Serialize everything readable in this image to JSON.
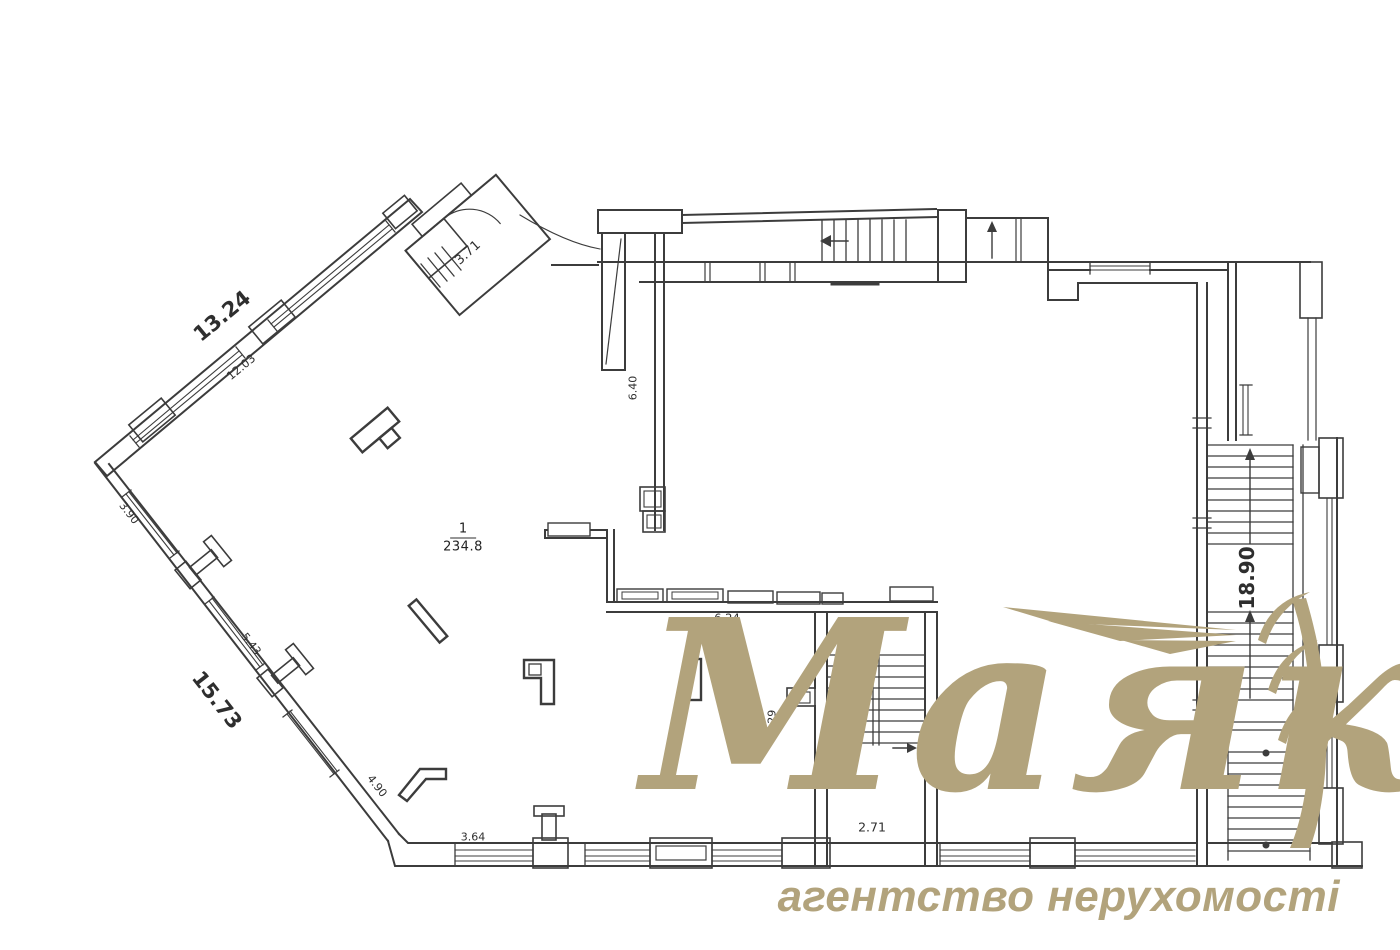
{
  "page": {
    "background": "#ffffff",
    "ink": "#3c3c3c"
  },
  "room": {
    "number": "1",
    "area": "234.8"
  },
  "dimensions": {
    "top_wall_outer": "13.24",
    "top_wall_inner": "12.03",
    "left_seg_a": "3.90",
    "left_seg_b": "5.43",
    "left_total": "15.73",
    "left_seg_c": "4.90",
    "bottom_seg": "3.64",
    "vestibule": "3.71",
    "duct_wall": "6.40",
    "partition": "6.24",
    "stair_depth": "7.29",
    "stair_width": "2.71",
    "right_total": "18.90"
  },
  "watermark": {
    "brand": "Маяк",
    "tagline": "агентство нерухомості",
    "color": "#b2a37c"
  }
}
